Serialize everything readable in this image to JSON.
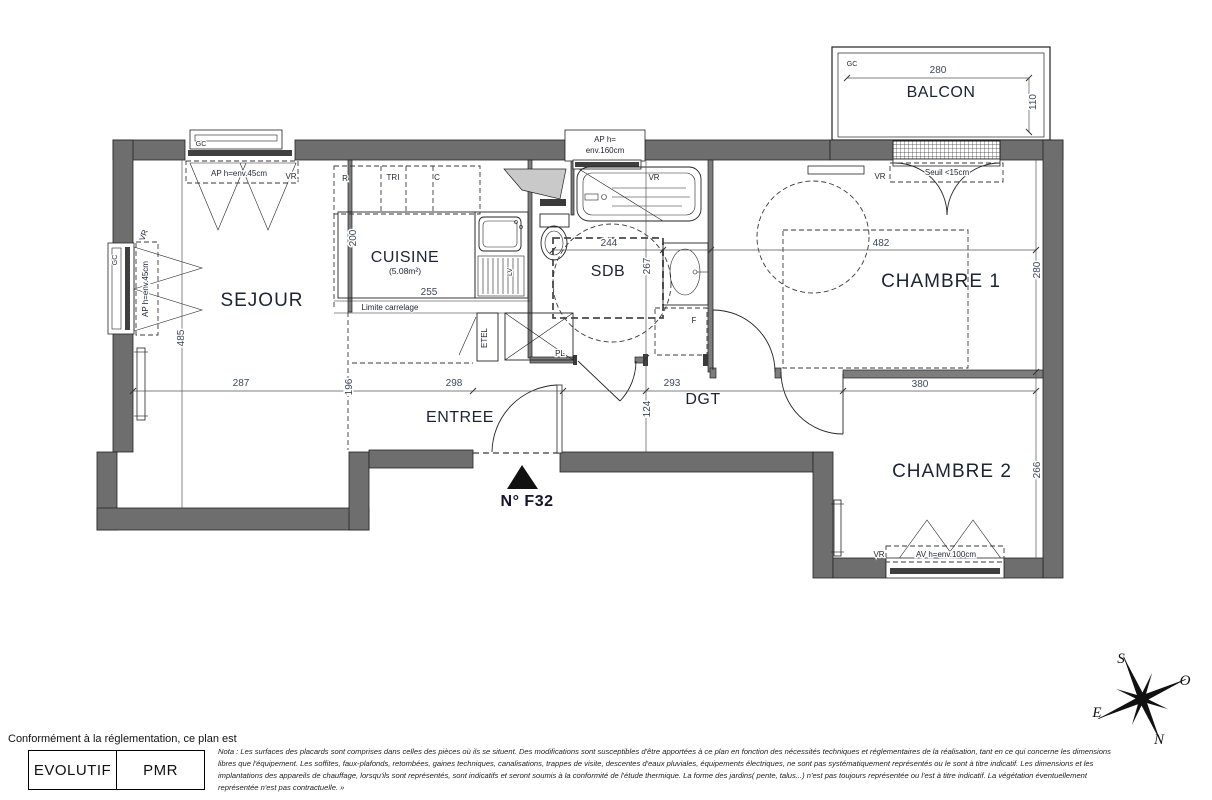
{
  "colors": {
    "wall": "#6e6e6e",
    "line": "#232323",
    "label": "#1c2335",
    "dim": "#3c4859",
    "accent": "#14142e"
  },
  "balcony": {
    "label": "BALCON",
    "gc": "GC",
    "width": "280",
    "height": "110"
  },
  "rooms": {
    "sejour": "SEJOUR",
    "cuisine": "CUISINE",
    "cuisine_area": "(5.08m²)",
    "sdb": "SDB",
    "entree": "ENTREE",
    "dgt": "DGT",
    "chambre1": "CHAMBRE 1",
    "chambre2": "CHAMBRE 2"
  },
  "dims": {
    "sejour_h": "485",
    "sejour_w": "287",
    "w196": "196",
    "entree_w": "298",
    "h124": "124",
    "dgt_w": "293",
    "chambre2_w": "380",
    "chambre1_h": "280",
    "chambre2_h": "266",
    "cuisine_h": "200",
    "cuisine_w": "255",
    "sdb_w": "244",
    "sdb_h": "267",
    "chambre1_w": "482"
  },
  "windows": {
    "gc_top": "GC",
    "gc_left": "GC",
    "vr_top": "VR",
    "vr_left": "VR",
    "vr_bath": "VR",
    "vr_chambre1": "VR",
    "vr_chambre2": "VR",
    "ap45_top": "AP  h=env.45cm",
    "ap45_left": "AP  h=env.45cm",
    "ap160_l1": "AP  h=",
    "ap160_l2": "env.160cm",
    "seuil": "Seuil <15cm",
    "av100": "AV  h=env.100cm"
  },
  "kitchen": {
    "r": "R",
    "tri": "TRI",
    "c": "C",
    "limite": "Limite carrelage",
    "lv": "LV"
  },
  "closets": {
    "etel": "ETEL",
    "pl": "PL",
    "f": "F"
  },
  "unit": {
    "number": "N° F32"
  },
  "compass": {
    "s": "S",
    "o": "O",
    "e": "E",
    "n": "N"
  },
  "footer": {
    "intro": "Conformément à la réglementation, ce plan est",
    "badges": [
      "EVOLUTIF",
      "PMR"
    ],
    "nota_lines": [
      "Nota : Les surfaces des placards sont comprises dans celles des pièces où ils se situent. Des modifications sont susceptibles d'être apportées à ce plan en fonction des nécessités techniques et réglementaires de la réalisation, tant en ce qui concerne les dimensions",
      "libres que l'équipement.  Les soffites, faux-plafonds, retombées, gaines techniques, canalisations, trappes de visite, descentes d'eaux pluviales, équipements électriques, ne sont pas systématiquement représentés ou le sont à titre indicatif. Les dimensions et les",
      "implantations des appareils de chauffage, lorsqu'ils sont représentés, sont indicatifs et seront soumis à la conformité de l'étude thermique. La forme des jardins( pente, talus...) n'est pas toujours représentée ou l'est à titre indicatif. La végétation éventuellement",
      "représentée n'est pas contractuelle. »"
    ]
  }
}
